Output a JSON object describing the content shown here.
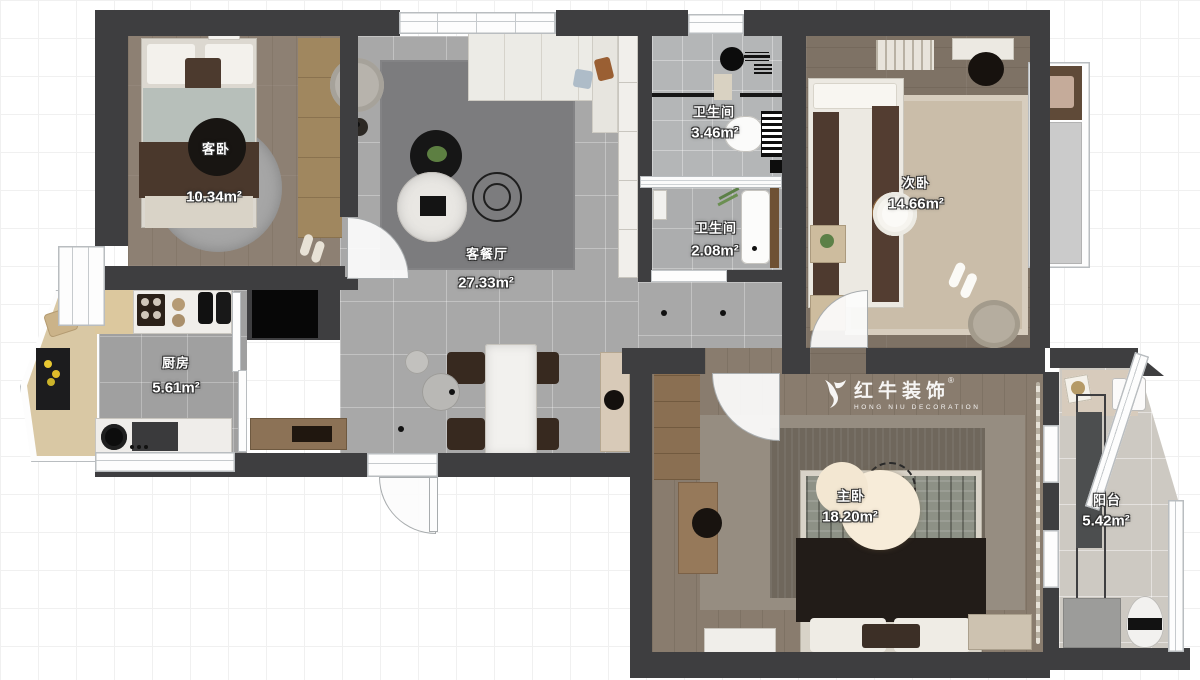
{
  "plan": {
    "title": "apartment-floor-plan",
    "rooms": [
      {
        "id": "guest-bedroom",
        "name": "客卧",
        "area": "10.34m²"
      },
      {
        "id": "living-dining",
        "name": "客餐厅",
        "area": "27.33m²"
      },
      {
        "id": "bathroom-1",
        "name": "卫生间",
        "area": "3.46m²"
      },
      {
        "id": "bathroom-2",
        "name": "卫生间",
        "area": "2.08m²"
      },
      {
        "id": "second-bedroom",
        "name": "次卧",
        "area": "14.66m²"
      },
      {
        "id": "kitchen",
        "name": "厨房",
        "area": "5.61m²"
      },
      {
        "id": "master-bedroom",
        "name": "主卧",
        "area": "18.20m²"
      },
      {
        "id": "balcony",
        "name": "阳台",
        "area": "5.42m²"
      }
    ],
    "watermark": {
      "brand": "红牛装饰",
      "brand_en": "HONG NIU DECORATION",
      "registered": "®"
    },
    "colors": {
      "wall": "#3e3e40",
      "living_tile": "#a8a8a8",
      "bedroom_wood": "#8d8073",
      "balcony_tile": "#cdc9c2",
      "label_text": "#ffffff"
    }
  }
}
